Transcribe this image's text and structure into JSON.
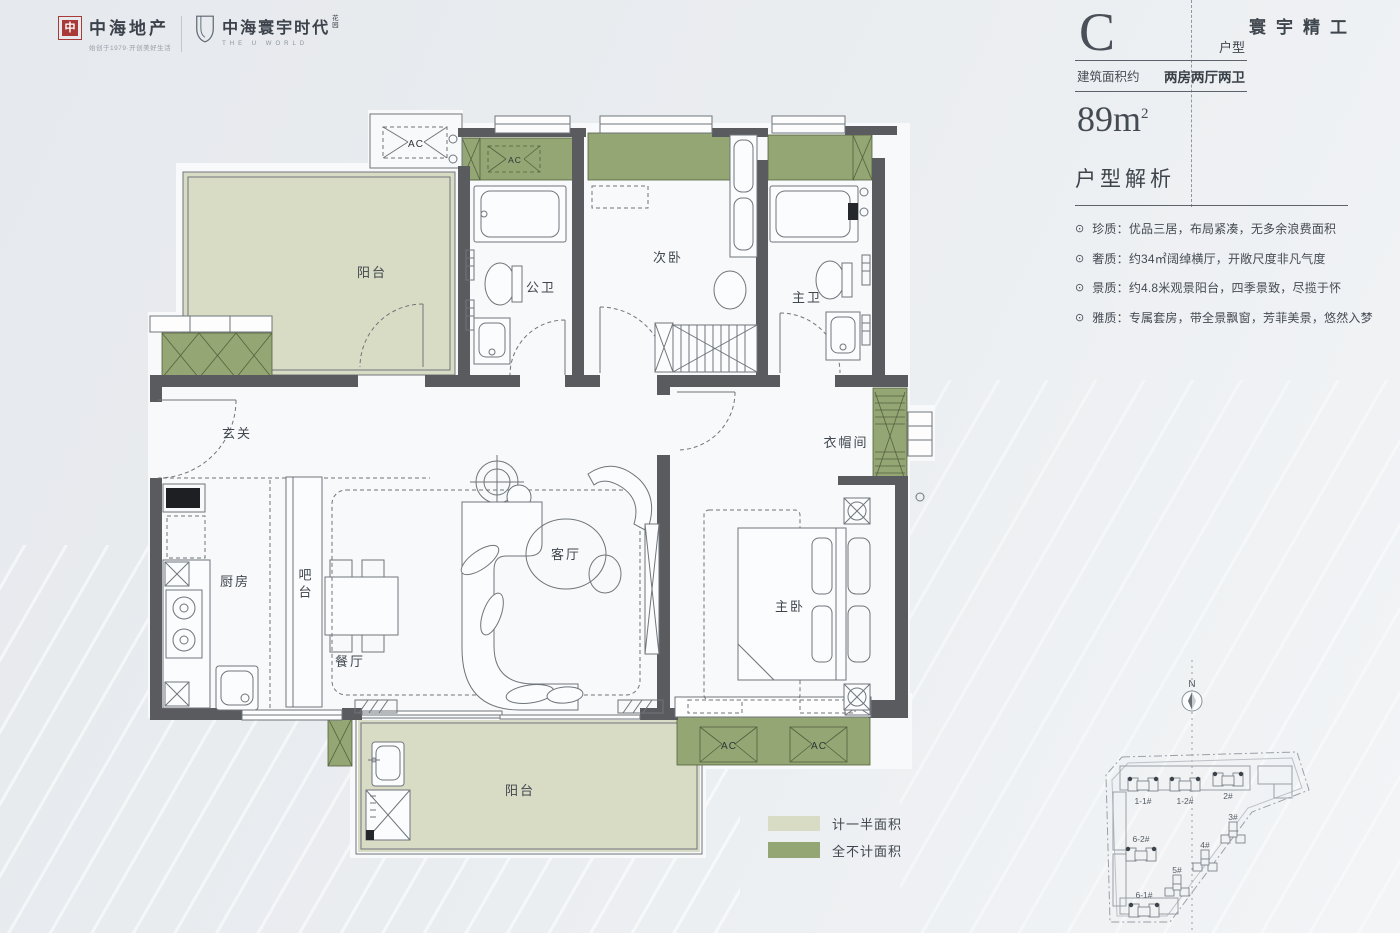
{
  "brand": {
    "logo1": {
      "mark": "中",
      "name": "中海地产",
      "tagline": "始创于1979·开创美好生活"
    },
    "logo2": {
      "name": "中海寰宇时代",
      "suffix": "花园",
      "subtitle": "THE U WORLD"
    }
  },
  "header": {
    "unit_letter": "C",
    "unit_label": "户型",
    "area_label": "建筑面积约",
    "layout": "两房两厅两卫",
    "area_value": "89m",
    "area_sup": "2",
    "slogan": "寰宇精工"
  },
  "analysis": {
    "title": "户型解析",
    "bullet_icon": "⊙",
    "bullets": [
      "珍质：优品三居，布局紧凑，无多余浪费面积",
      "奢质：约34㎡阔绰横厅，开敞尺度非凡气度",
      "景质：约4.8米观景阳台，四季景致，尽揽于怀",
      "雅质：专属套房，带全景飘窗，芳菲美景，悠然入梦"
    ]
  },
  "floorplan": {
    "rooms": {
      "balcony_top": "阳台",
      "bath_public": "公卫",
      "bedroom_second": "次卧",
      "bath_master": "主卫",
      "entry": "玄关",
      "kitchen": "厨房",
      "bar": "吧台",
      "dining": "餐厅",
      "living": "客厅",
      "bedroom_master": "主卧",
      "cloakroom": "衣帽间",
      "balcony_bottom": "阳台"
    },
    "ac_label": "AC",
    "colors": {
      "half_area": "#d9dcc4",
      "excluded_area": "#93a673",
      "wall": "#595b5e"
    }
  },
  "legend": {
    "items": [
      {
        "color": "#d9dcc4",
        "label": "计一半面积"
      },
      {
        "color": "#93a673",
        "label": "全不计面积"
      }
    ]
  },
  "siteplan": {
    "north_label": "N",
    "buildings": [
      {
        "label": "1-1#"
      },
      {
        "label": "1-2#"
      },
      {
        "label": "2#"
      },
      {
        "label": "3#"
      },
      {
        "label": "4#"
      },
      {
        "label": "5#"
      },
      {
        "label": "6-2#"
      },
      {
        "label": "6-1#"
      }
    ]
  }
}
